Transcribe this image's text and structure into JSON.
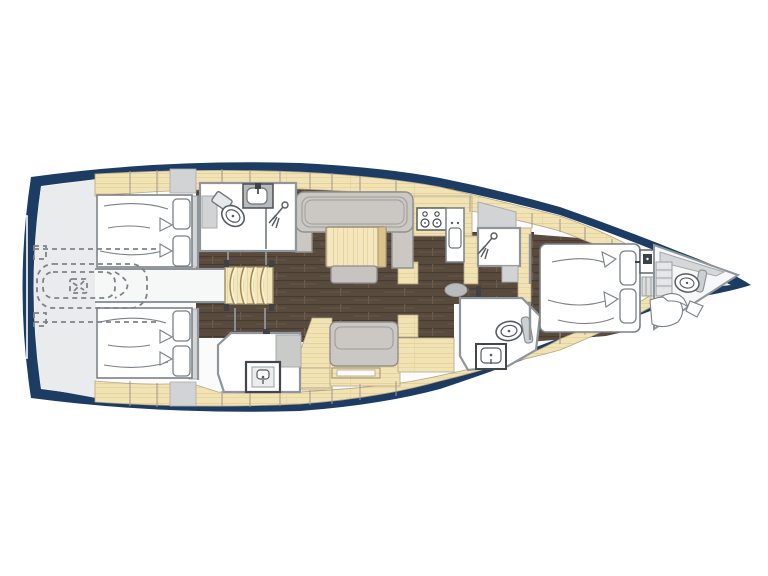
{
  "diagram": {
    "label": "Sailing yacht interior layout floor plan, bow pointing right",
    "type": "yacht-deck-plan",
    "orientation": "bow-right"
  },
  "colors": {
    "hull": "#1d3c63",
    "interior": "#fbfbfb",
    "dark_wood_floor": "#594a3e",
    "cabinetry_wood": "#f2e3b4",
    "upholstery_gray": "#cbc8c4",
    "wet_room_white": "#ffffff",
    "stern_platform_gray": "#e9ebed",
    "dashed_outline": "#7d838a"
  },
  "areas": [
    {
      "name": "stern-platform",
      "desc": "transom / swim platform area"
    },
    {
      "name": "tender-garage",
      "desc": "dashed stowed dinghy with outboard motor under cockpit"
    },
    {
      "name": "aft-cabin-port",
      "desc": "double berth with two pillows"
    },
    {
      "name": "aft-cabin-starboard",
      "desc": "double berth with two pillows"
    },
    {
      "name": "companionway-stairs",
      "desc": "curved steps down from cockpit"
    },
    {
      "name": "aft-head-port",
      "desc": "toilet, washbasin and separate shower"
    },
    {
      "name": "aft-head-starboard",
      "desc": "washbasin and shower area"
    },
    {
      "name": "salon",
      "desc": "U-sofa with table, ottoman and side cabinet"
    },
    {
      "name": "starboard-settee",
      "desc": "straight bench with shelf"
    },
    {
      "name": "galley",
      "desc": "stove with four burners, counter and sink"
    },
    {
      "name": "forward-shower-port",
      "desc": "separate shower compartment"
    },
    {
      "name": "forward-head-starboard",
      "desc": "toilet and washbasin"
    },
    {
      "name": "owner-cabin",
      "desc": "forward double berth with two pillows, vanity and steps"
    },
    {
      "name": "forepeak",
      "desc": "bow compartment with toilet, steps and cushions"
    }
  ],
  "icons": [
    "toilet-icon",
    "shower-head-icon",
    "sink-basin-icon",
    "faucet-icon",
    "stove-burners-icon",
    "tender-outline-icon",
    "steps-icon"
  ]
}
